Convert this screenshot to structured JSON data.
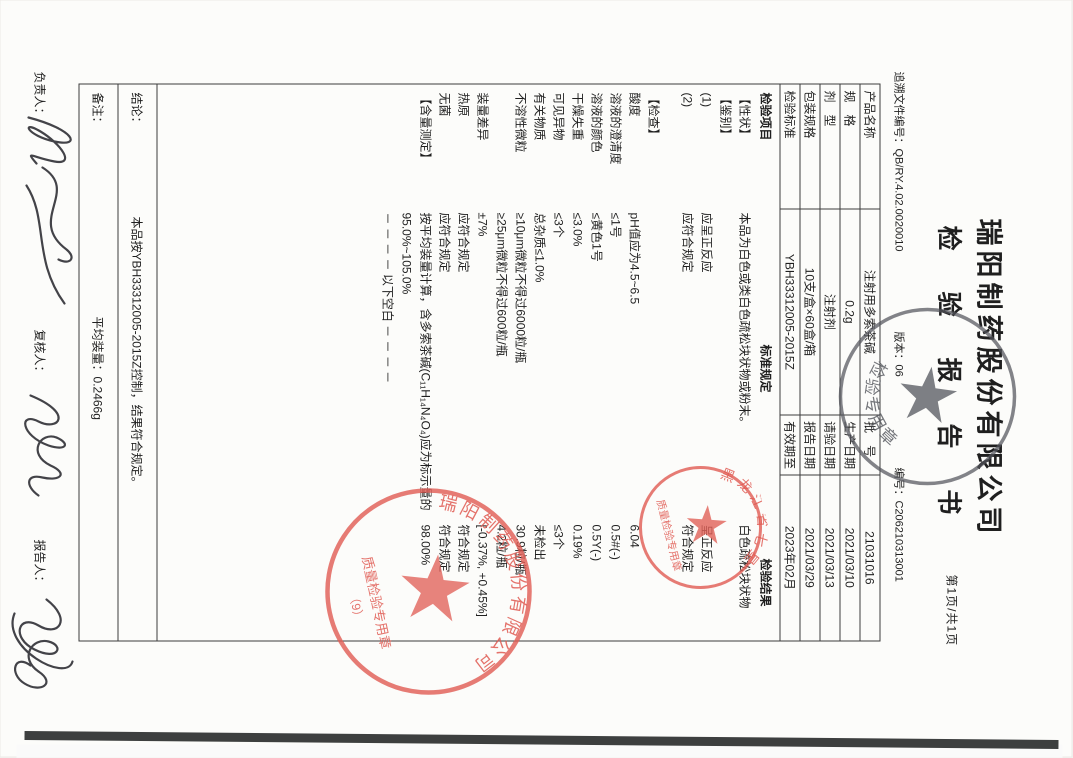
{
  "header": {
    "company": "瑞阳制药股份有限公司",
    "title": "检 验 报 告 书",
    "page_indicator": "第1页/共1页",
    "trace_no": "追溯文件编号：QB/RY.4.02.0020010",
    "version": "版本：06",
    "report_no": "编号：C206210313001"
  },
  "info_table": {
    "rows": [
      [
        "产品名称",
        "注射用多索茶碱",
        "批　号",
        "21031016"
      ],
      [
        "规　格",
        "0.2g",
        "生产日期",
        "2021/03/10"
      ],
      [
        "剂　型",
        "注射剂",
        "请验日期",
        "2021/03/13"
      ],
      [
        "包装规格",
        "10支/盒×60盒/箱",
        "报告日期",
        "2021/03/29"
      ],
      [
        "检验标准",
        "YBH33312005-2015Z",
        "有效期至",
        "2023年02月"
      ]
    ]
  },
  "result_table": {
    "headers": [
      "检验项目",
      "标准规定",
      "检验结果"
    ],
    "rows": [
      [
        "【性状】",
        "本品为白色或类白色疏松块状物或粉末。",
        "白色疏松块状物"
      ],
      [
        "【鉴别】",
        "",
        ""
      ],
      [
        "(1)",
        "应呈正反应",
        "呈正反应"
      ],
      [
        "(2)",
        "应符合规定",
        "符合规定"
      ],
      [
        "",
        "",
        ""
      ],
      [
        "【检查】",
        "",
        ""
      ],
      [
        "酸度",
        "pH值应为4.5~6.5",
        "6.04"
      ],
      [
        "溶液的澄清度",
        "≤1号",
        "0.5#(-)"
      ],
      [
        "溶液的颜色",
        "≤黄色1号",
        "0.5Y(-)"
      ],
      [
        "干燥失重",
        "≤3.0%",
        "0.19%"
      ],
      [
        "可见异物",
        "≤3个",
        "≤3个"
      ],
      [
        "有关物质",
        "总杂质≤1.0%",
        "未检出"
      ],
      [
        "不溶性微粒",
        "≥10μm微粒不得过6000粒/瓶",
        "30.9粒/瓶"
      ],
      [
        "",
        "≥25μm微粒不得过600粒/瓶",
        "4.2粒/瓶"
      ],
      [
        "装量差异",
        "±7%",
        "[-0.37%, +0.45%]"
      ],
      [
        "热原",
        "应符合规定",
        "符合规定"
      ],
      [
        "无菌",
        "应符合规定",
        "符合规定"
      ],
      [
        "【含量测定】",
        "按平均装量计算，含多索茶碱(C₁₁H₁₄N₄O₄)应为标示量的95.0%~105.0%",
        "98.00%"
      ],
      [
        "",
        "－ － － － 以下空白 － － － －",
        ""
      ]
    ]
  },
  "conclusion": {
    "label": "结论：",
    "text": "本品按YBH33312005-2015Z控制，结果符合规定。"
  },
  "remark": {
    "label": "备注：",
    "text": "平均装量：0.2466g"
  },
  "signatures": {
    "responsible": "负责人：",
    "reviewer": "复核人：",
    "reporter": "报告人："
  },
  "stamps": {
    "title_stamp": {
      "arc_text": "检验专用章",
      "color": "#53555c"
    },
    "regional_stamp": {
      "arc_top": "黑龙江省七星",
      "line_text": "质量检验专用章",
      "color": "#e05a52"
    },
    "company_stamp": {
      "arc_top": "瑞阳制药股份有限公司",
      "line_text": "质量检验专用章",
      "sub_text": "（9）",
      "color": "#e05a52"
    }
  }
}
